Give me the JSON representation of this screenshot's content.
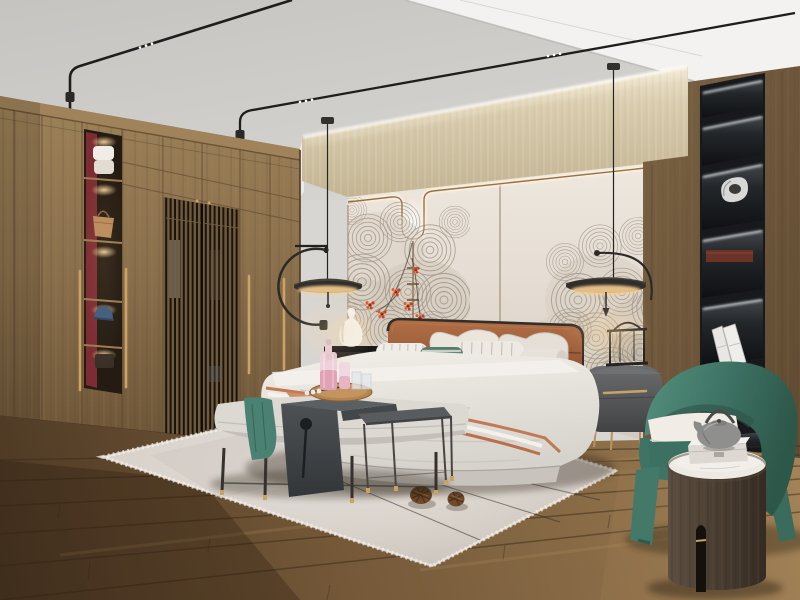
{
  "scene": {
    "description": "Photorealistic 3D render of a modern new-Chinese style bedroom with walnut wardrobe, leather headboard bed, teal armchair and black disc pendant lamps",
    "room": "bedroom",
    "lighting": [
      "curved black ceiling light tracks with LED spots",
      "cove lighting above accent wall",
      "two black disc pendant lamps",
      "lit display niches"
    ]
  },
  "objects": {
    "ceiling": {
      "label": "white plaster ceiling with dropped bulkhead"
    },
    "track_lights": {
      "label": "curved black ceiling light tracks with tiny LED spots"
    },
    "accent_wall": {
      "label": "beige textured band over greige wall panels with bronze trim"
    },
    "mural": {
      "label": "grey concentric wave fan line-art with red blossom branches"
    },
    "wardrobe": {
      "label": "floor-to-ceiling walnut wardrobe with slatted screen doors and brass pulls"
    },
    "display_niche": {
      "label": "lit wardrobe display shelves with maroon back panel",
      "items": [
        "folded white towels",
        "tan handbag",
        "blue cap",
        "dark box"
      ]
    },
    "pendant_left": {
      "label": "black disc pendant lamp with C-shaped arm"
    },
    "pendant_right": {
      "label": "black disc pendant lamp with curved counterweight arm"
    },
    "bed": {
      "label": "upholstered platform bed",
      "headboard": "cognac leather panelled headboard",
      "bedding": "white layered duvet with terracotta trim runner"
    },
    "pillows": {
      "label": "pillow arrangement",
      "list": [
        "white euro pillows",
        "grey pinstripe pillows",
        "teal lumbar pillow",
        "white bolster"
      ]
    },
    "nightstand_left": {
      "label": "dark wood nightstand with white gourd vase lamp"
    },
    "nightstand_right": {
      "label": "grey oval nightstand with brass handle, legs and black lantern decor"
    },
    "bench": {
      "label": "grey upholstered bed-end bench with teal throw"
    },
    "c_table": {
      "label": "dark grey waterfall side table straddling the bench"
    },
    "tray": {
      "label": "round wooden tray with pink decanter, bottle and glasses"
    },
    "side_table_small": {
      "label": "slim grey metal accent table with brass feet"
    },
    "armchair": {
      "label": "teal curved barrel armchair with white seat cushion"
    },
    "drum_table": {
      "label": "dark wood drum side table with marble top and slot cutout"
    },
    "teapot": {
      "label": "grey cast-iron style teapot"
    },
    "gift_box": {
      "label": "white keepsake box"
    },
    "shelf_column": {
      "label": "black recessed display shelving with LED strips",
      "items": [
        "silver abstract sculpture",
        "dark red wooden box",
        "white books"
      ]
    },
    "rug": {
      "label": "light grey area rug with thin line motif and fringe"
    },
    "pinecones": {
      "label": "two decorative pinecones"
    },
    "floor": {
      "label": "rustic oak plank floor"
    }
  },
  "palette": {
    "ceiling": "#d8d6d3",
    "ceiling_dark": "#c6c4c1",
    "bulkhead": "#f3f2f0",
    "beige_light": "#f6eedb",
    "beige_wall": "#dacdb0",
    "beige_dark": "#c2b493",
    "panel_light": "#efe8de",
    "panel_wall": "#e4dcd2",
    "panel_dark": "#d2c8be",
    "trim_bronze": "#96704c",
    "art_stroke": "#8a7f71",
    "wood_light": "#9c8158",
    "wood_mid": "#8a6f4c",
    "wood_dark": "#6b5436",
    "wood_right": "#7b6244",
    "wood_right_dark": "#5f4a31",
    "maroon": "#8c2f38",
    "floor_dark": "#4a3723",
    "floor_mid": "#745838",
    "floor_light": "#a8875a",
    "rug": "#d8d2cb",
    "rug_dark": "#c6bfb8",
    "rug_light": "#e5e0da",
    "leather_light": "#b06f46",
    "leather": "#8d4f30",
    "teal_light": "#55907e",
    "teal_chair": "#3d7163",
    "teal_dark": "#2d5749",
    "teal_textile": "#4a8172",
    "brass": "#c9a264",
    "shelf_black": "#17191c",
    "gray_table": "#4e5356",
    "nightstand_gray": "#55575a",
    "terracotta": "#c07a54",
    "blossom_red": "#c8421f",
    "glow_warm": "#ffd9a0",
    "white_soft": "#f0ede7",
    "cyl_wood": "#4a3e32"
  }
}
